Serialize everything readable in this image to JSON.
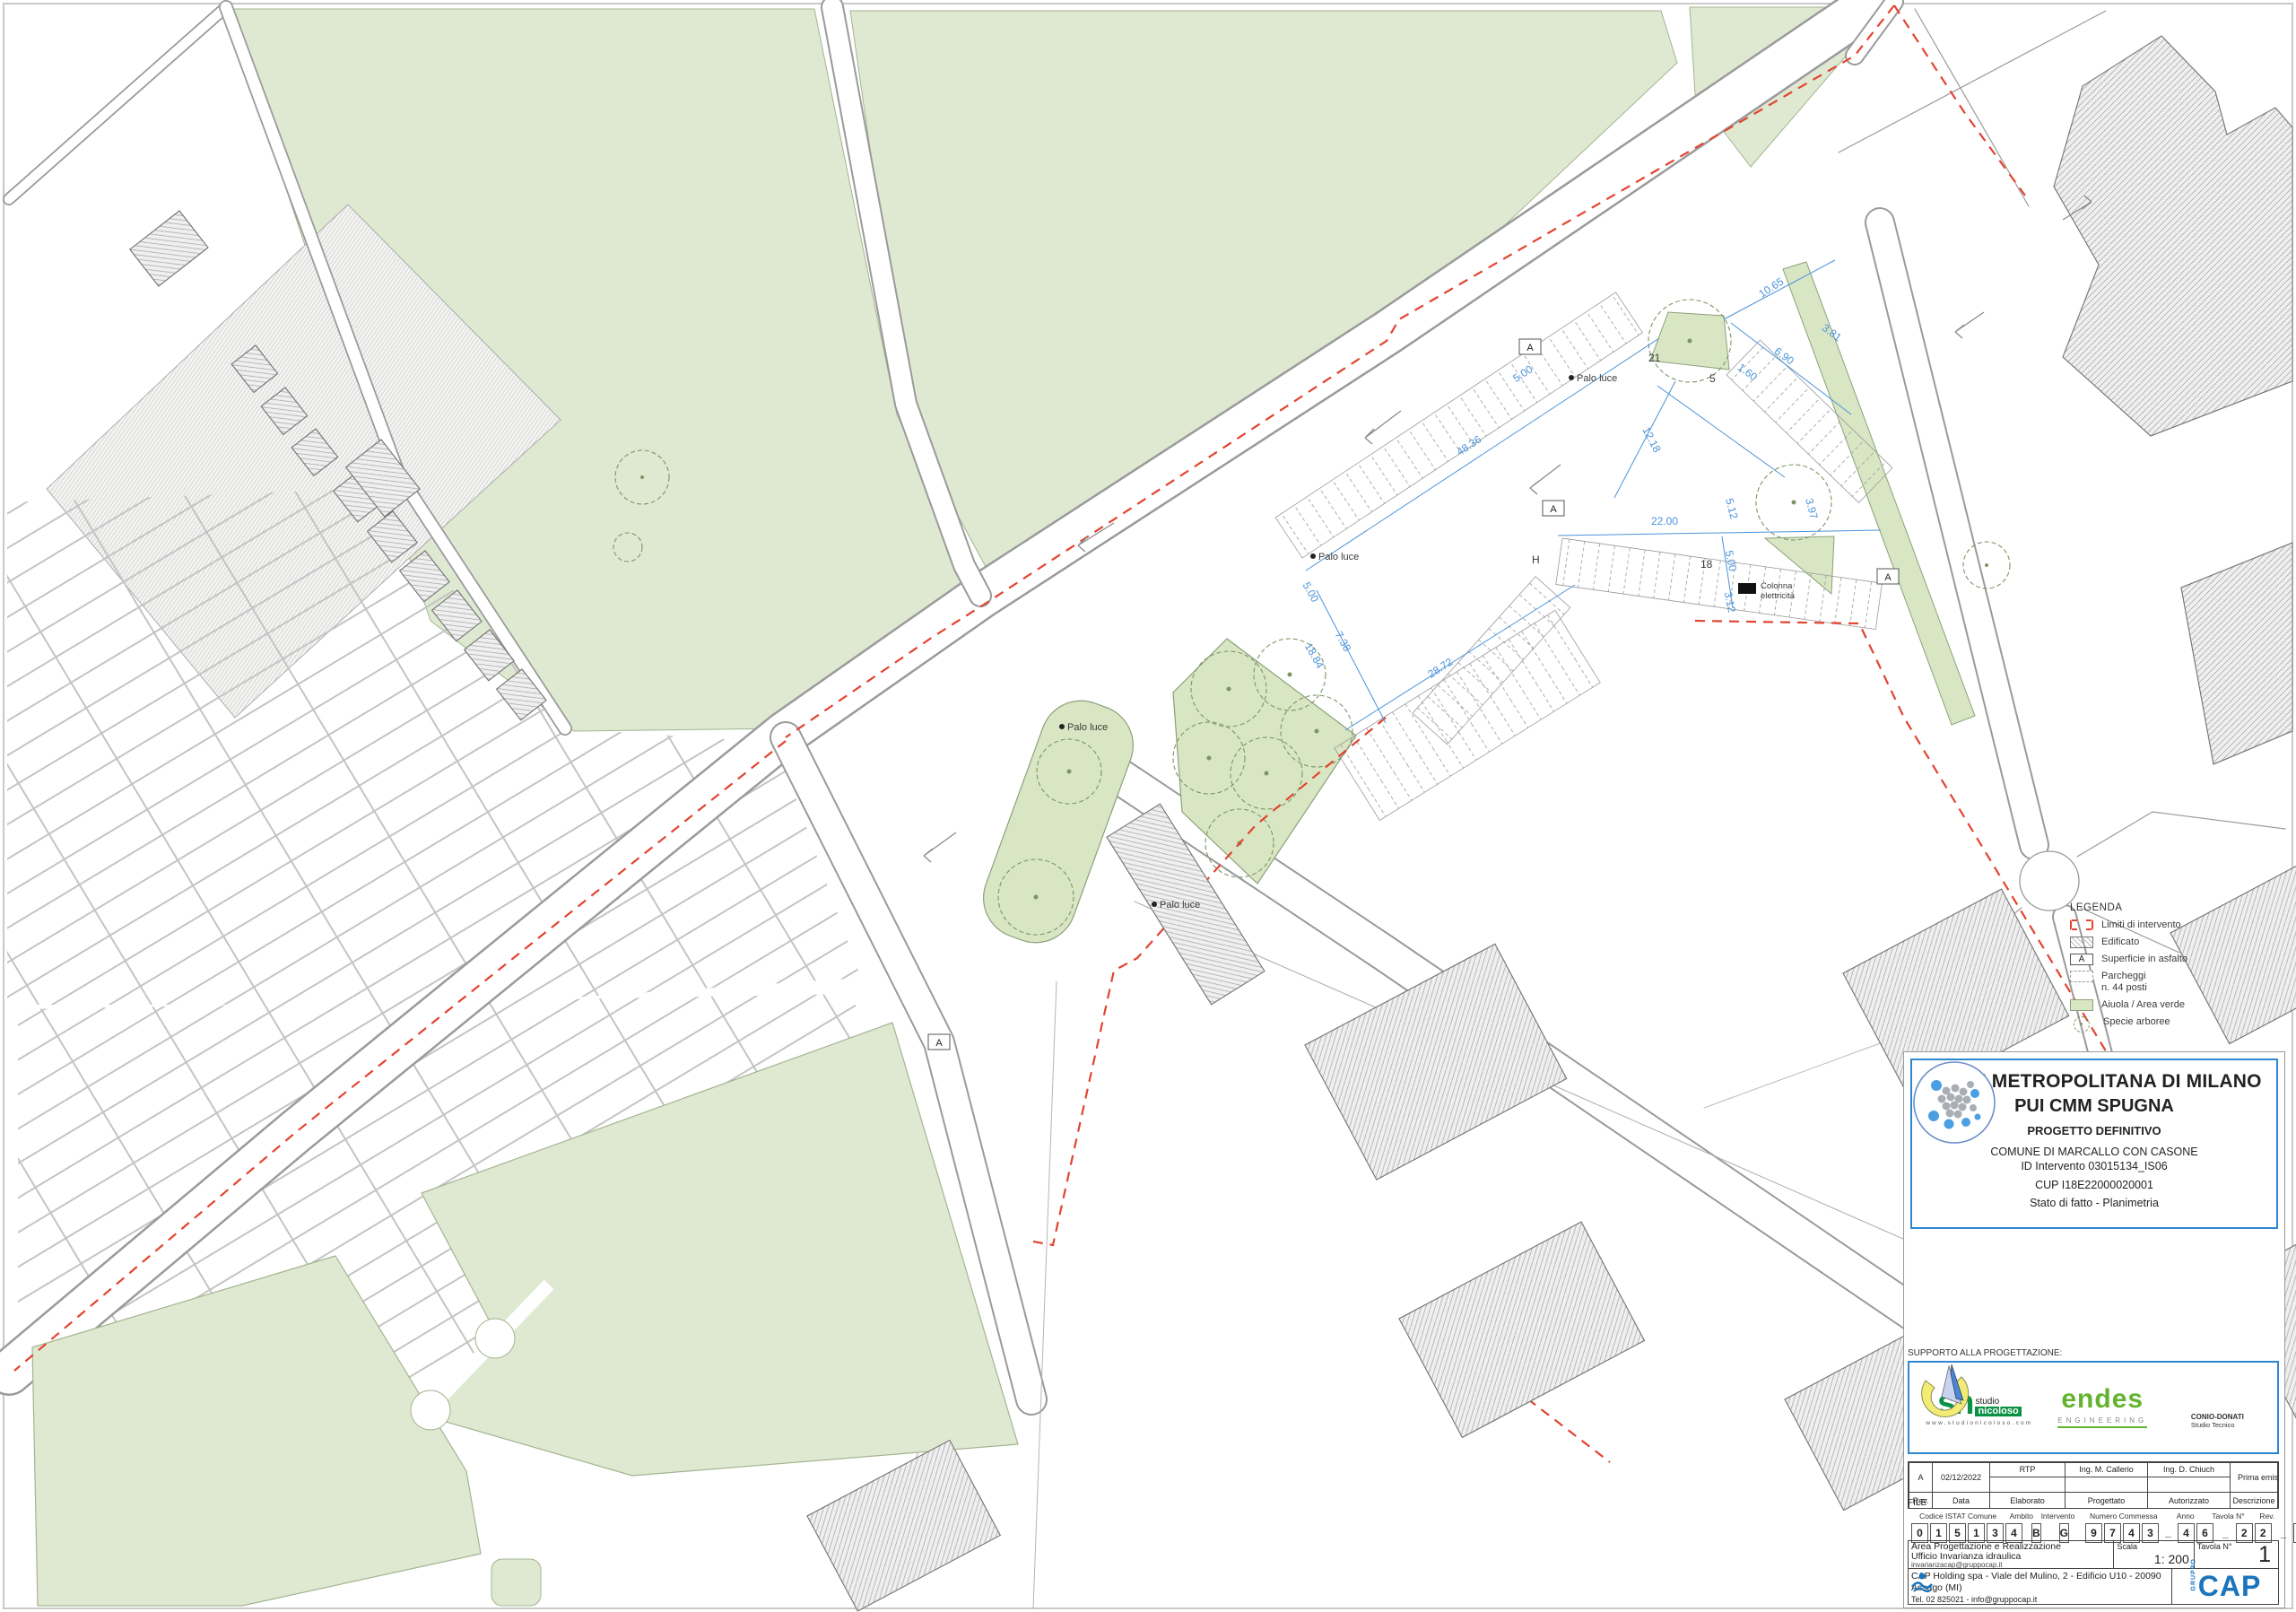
{
  "drawing": {
    "title_block": {
      "header": {
        "line1": "CITTA' METROPOLITANA DI MILANO",
        "line2": "PUI CMM SPUGNA",
        "line3": "PROGETTO DEFINITIVO",
        "line4": "COMUNE DI MARCALLO CON CASONE",
        "line5": "ID Intervento 03015134_IS06",
        "line6": "CUP I18E22000020001",
        "line7": "Stato di fatto - Planimetria"
      },
      "support_label": "SUPPORTO ALLA PROGETTAZIONE:",
      "logos": {
        "nicoloso_mark": "sn",
        "nicoloso_prefix": "studio",
        "nicoloso_name": "nicoloso",
        "nicoloso_url": "www.studionicoloso.com",
        "endes_name": "endes",
        "endes_sub": "ENGINEERING",
        "conio_name": "CONIO-DONATI",
        "conio_sub": "Studio Tecnico"
      },
      "revision_row": {
        "rev": "A",
        "date": "02/12/2022",
        "elaborato": "RTP",
        "progettato": "Ing. M. Callerio",
        "autorizzato": "Ing. D. Chiuch",
        "descrizione": "Prima emissione"
      },
      "revision_headers": {
        "rev": "Rev.",
        "data": "Data",
        "elaborato": "Elaborato",
        "progettato": "Progettato",
        "autorizzato": "Autorizzato",
        "descrizione": "Descrizione"
      },
      "file_label": "FILE",
      "code": {
        "istat_label": "Codice ISTAT Comune",
        "istat_digits": [
          "0",
          "1",
          "5",
          "1",
          "3",
          "4"
        ],
        "ambito_label": "Ambito",
        "ambito": "B",
        "intervento_label": "Intervento",
        "intervento": "G",
        "commessa_label": "Numero Commessa",
        "commessa_digits": [
          "9",
          "7",
          "4",
          "3",
          "_",
          "4",
          "6"
        ],
        "sep1": "_",
        "anno_label": "Anno",
        "anno_digits": [
          "2",
          "2"
        ],
        "sep2": "_",
        "tavola_label": "Tavola N°",
        "tavola_digits": [
          "0",
          "0",
          "1"
        ],
        "rev_label": "Rev.",
        "rev": "A"
      },
      "org": {
        "line1": "Area Progettazione e Realizzazione",
        "line2": "Ufficio Invarianza idraulica",
        "line3": "invarianzacap@gruppocap.it"
      },
      "scala_label": "Scala",
      "scala_value": "1: 200",
      "tavola_n_label": "Tavola N°",
      "tavola_n_value": "1",
      "company": {
        "line1": "CAP Holding spa - Viale del Mulino, 2 - Edificio U10 - 20090 Assago (MI)",
        "line2": "Tel. 02 825021 - info@gruppocap.it",
        "fineprint": "Il disegno è di nostra proprietà esclusiva ed è posto sotto tutela della legge, ne è proibita la riproduzione anche parziale e la cessione a terzi senza nostra autorizzazione scritta.",
        "gruppo": "GRUPPO",
        "cap": "CAP"
      }
    },
    "legend": {
      "title": "LEGENDA",
      "items": [
        {
          "label": "Limiti di intervento"
        },
        {
          "label": "Edificato"
        },
        {
          "label": "Superficie in asfalto"
        },
        {
          "label": "Parcheggi",
          "label2": "n. 44 posti"
        },
        {
          "label": "Aiuola / Area verde"
        },
        {
          "label": "Specie arboree"
        }
      ]
    },
    "map_labels": {
      "palo_luce": "Palo luce",
      "colonna_line1": "Colonna",
      "colonna_line2": "elettricità",
      "asfalto_marker": "A",
      "h_label": "H",
      "count_21": "21",
      "count_5": "5",
      "count_18": "18"
    },
    "dimensions": {
      "d1": "48.36",
      "d2": "28.72",
      "d3": "22.00",
      "d4": "12.18",
      "d5": "10.65",
      "d6": "7.38",
      "d7": "6.90",
      "d8": "5.00",
      "d9": "3.81",
      "d10": "1.60",
      "d11": "3.12",
      "d12": "5.12",
      "d13": "3.97",
      "d14": "18.84"
    },
    "colors": {
      "green_field": "#dfe9d2",
      "green_area": "#d9e6c4",
      "red_boundary": "#e2442f",
      "dim_blue": "#4a93d9",
      "title_border": "#2e86d1",
      "cap_blue": "#1b75bc",
      "endes_green": "#63b32e",
      "nicoloso_green": "#0a9144",
      "conio_yellow": "#f3ec74"
    }
  }
}
